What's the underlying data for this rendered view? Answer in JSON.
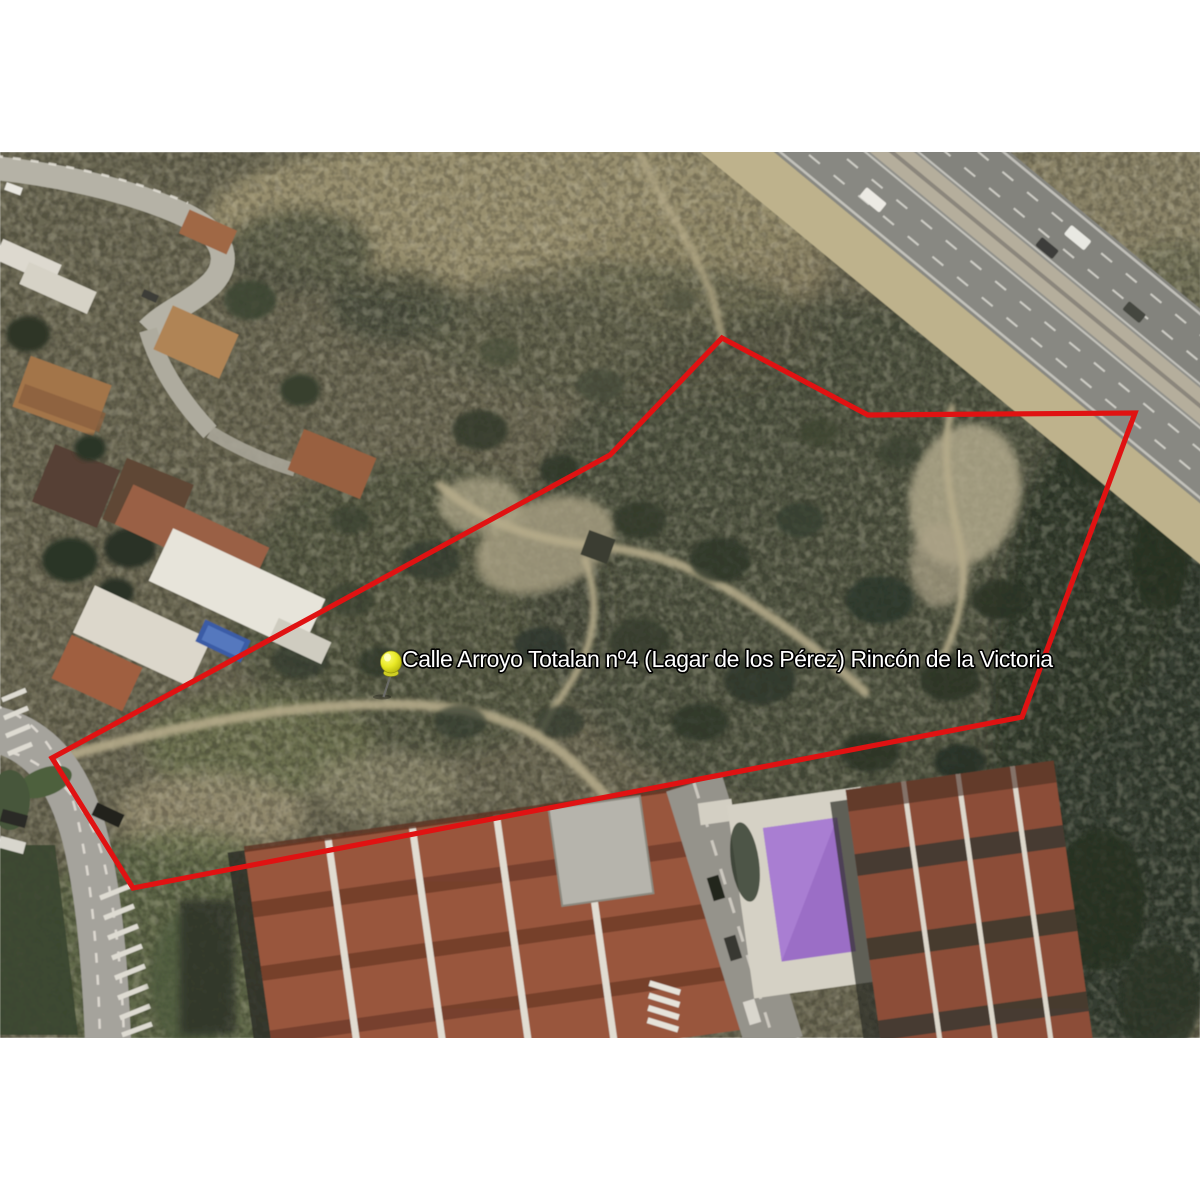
{
  "window": {
    "background_color": "#ffffff"
  },
  "map": {
    "kind": "satellite-imagery",
    "pin": {
      "label": "Calle Arroyo Totalan nº4 (Lagar de los Pérez) Rincón de la Victoria",
      "color": "#e9e926",
      "transform": "translate(388,666)"
    },
    "parcel": {
      "points": "722,338 868,415 1135,413 1022,717 133,888 52,758 610,455",
      "outline_color": "#e01212"
    },
    "label_style": {
      "fill": "#ffffff",
      "outline": "#000000"
    }
  }
}
